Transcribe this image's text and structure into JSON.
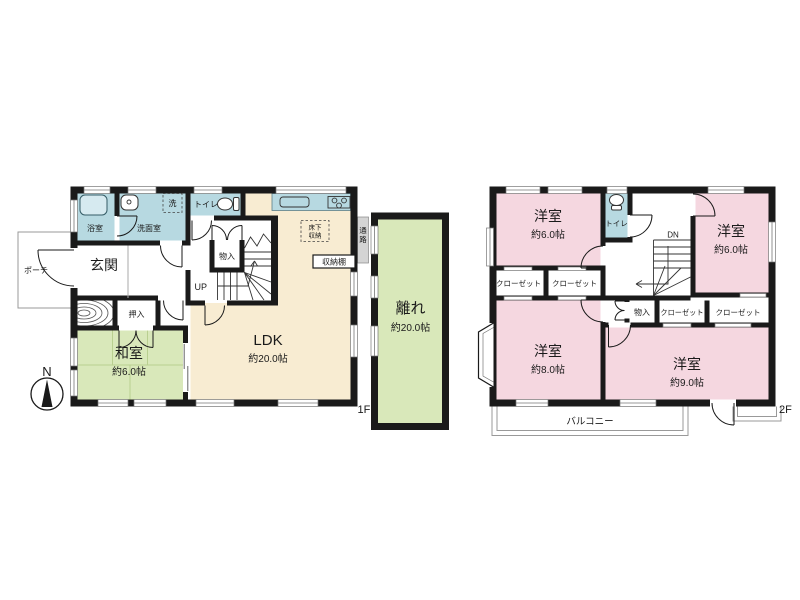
{
  "plan": {
    "compass_label": "N",
    "colors": {
      "wall": "#1a1a1a",
      "water": "#b7d9e1",
      "ldk": "#f8ecd2",
      "tatami_room": "#d9e8ba",
      "bedroom": "#f5d7e0",
      "passage": "#d4d4d4"
    },
    "floor1": {
      "floor_label": "1F",
      "porch": "ポーチ",
      "entrance": "玄関",
      "bath": "浴室",
      "washroom": "洗面室",
      "laundry": "洗",
      "toilet": "トイレ",
      "closet_oshiire": "押入",
      "storage_monoire": "物入",
      "stairs_up": "UP",
      "underfloor_storage_line1": "床下",
      "underfloor_storage_line2": "収納",
      "storage_shelf": "収納棚",
      "passage_line1": "通",
      "passage_line2": "路",
      "washitsu_name": "和室",
      "washitsu_size": "約6.0帖",
      "ldk_name": "LDK",
      "ldk_size": "約20.0帖",
      "hanare_name": "離れ",
      "hanare_size": "約20.0帖"
    },
    "floor2": {
      "floor_label": "2F",
      "toilet": "トイレ",
      "stairs_down": "DN",
      "storage_monoire": "物入",
      "closet_label": "クローゼット",
      "balcony": "バルコニー",
      "rooms": [
        {
          "name": "洋室",
          "size": "約6.0帖"
        },
        {
          "name": "洋室",
          "size": "約6.0帖"
        },
        {
          "name": "洋室",
          "size": "約8.0帖"
        },
        {
          "name": "洋室",
          "size": "約9.0帖"
        }
      ]
    }
  }
}
